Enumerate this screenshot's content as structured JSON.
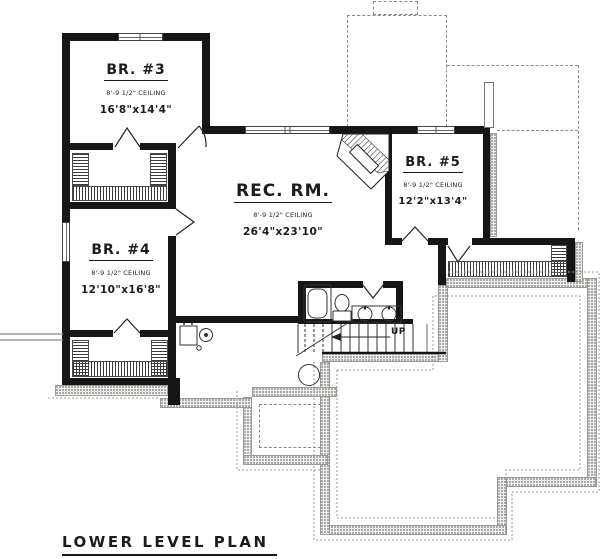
{
  "title": {
    "text": "LOWER LEVEL PLAN"
  },
  "rooms": [
    {
      "name": "BR. #3",
      "ceiling": "8'-9 1/2\" CEILING",
      "dims": "16'8\"x14'4\""
    },
    {
      "name": "BR. #4",
      "ceiling": "8'-9 1/2\" CEILING",
      "dims": "12'10\"x16'8\""
    },
    {
      "name": "REC. RM.",
      "ceiling": "8'-9 1/2\" CEILING",
      "dims": "26'4\"x23'10\""
    },
    {
      "name": "BR. #5",
      "ceiling": "8'-9 1/2\" CEILING",
      "dims": "12'2\"x13'4\""
    }
  ],
  "stairs": {
    "up_label": "UP"
  },
  "colors": {
    "wall": "#161616",
    "hatch": "#3c3c3c",
    "stipple_dot": "#6b6b6b",
    "dashed": "#8a8a8a"
  }
}
